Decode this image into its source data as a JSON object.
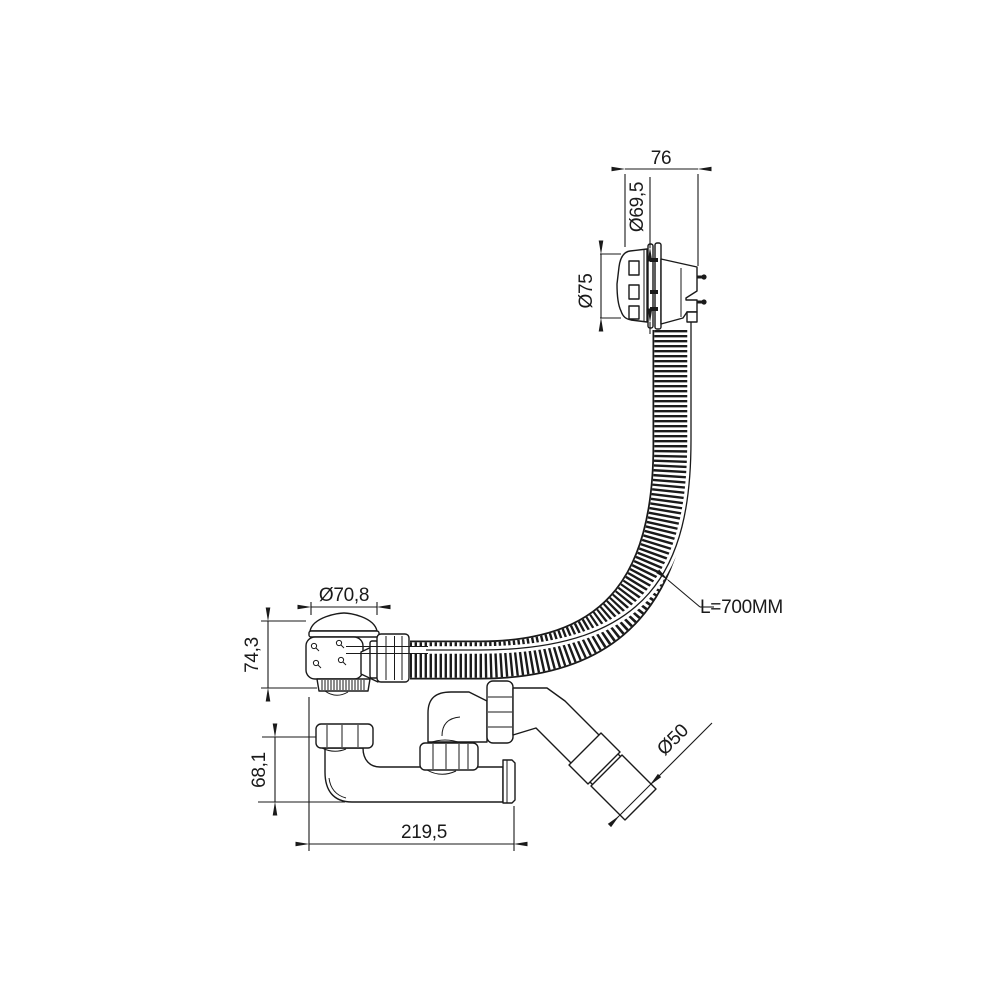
{
  "drawing": {
    "dimensions": {
      "overflow_depth": "76",
      "overflow_pipe_dia": "Ø69,5",
      "overflow_cap_dia": "Ø75",
      "hose_length": "L=700MM",
      "plug_dia": "Ø70,8",
      "waste_height": "74,3",
      "trap_height": "68,1",
      "trap_length": "219,5",
      "outlet_dia": "Ø50"
    }
  }
}
